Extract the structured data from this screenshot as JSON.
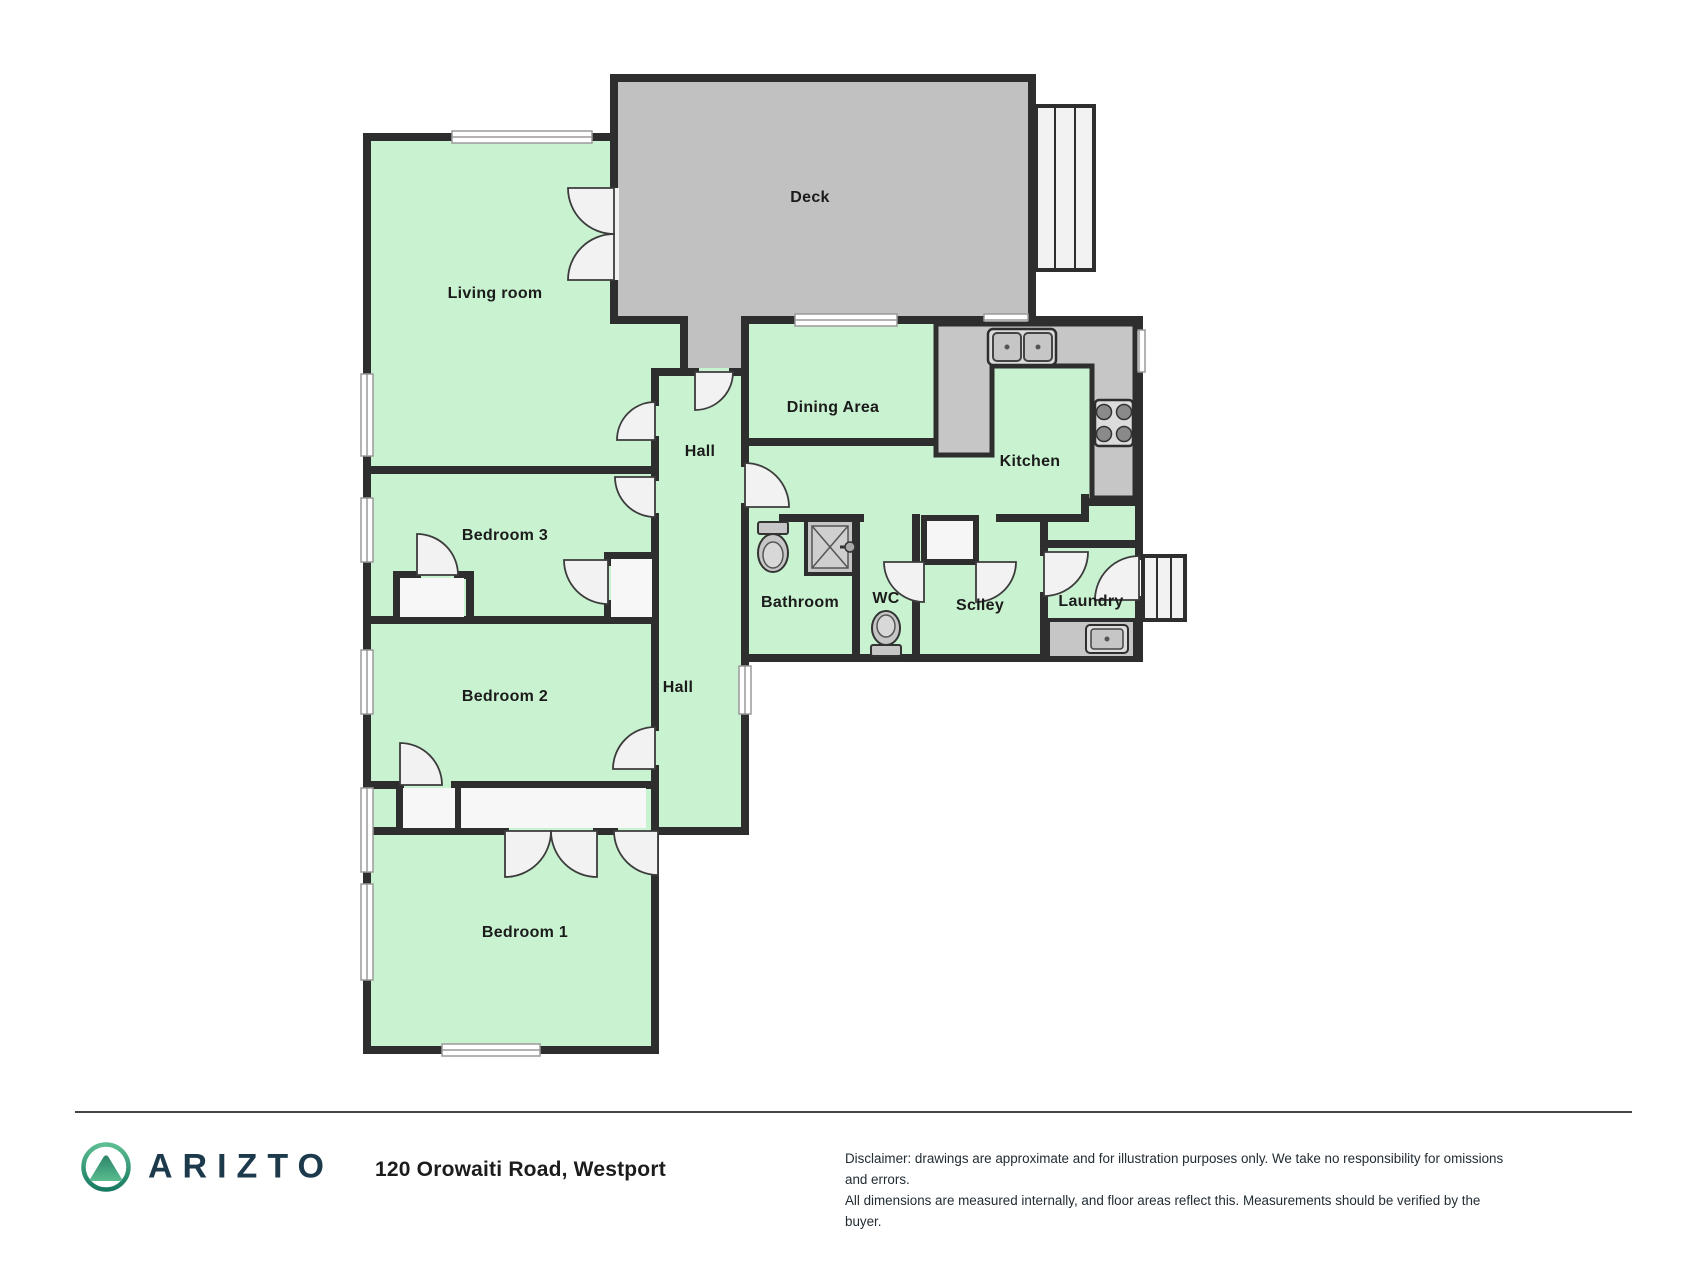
{
  "floorplan": {
    "rooms": {
      "living": "Living room",
      "deck": "Deck",
      "hall_upper": "Hall",
      "dining": "Dining Area",
      "kitchen": "Kitchen",
      "bathroom": "Bathroom",
      "wc": "WC",
      "scullery": "Sclley",
      "laundry": "Laundry",
      "hall_lower": "Hall",
      "bedroom3": "Bedroom 3",
      "bedroom2": "Bedroom 2",
      "bedroom1": "Bedroom 1"
    },
    "colors": {
      "room_fill": "#c9f3d0",
      "deck_fill": "#c1c1c1",
      "counter_fill": "#c6c6c6",
      "wall": "#2e2e2e"
    }
  },
  "footer": {
    "brand": "ARIZTO",
    "address": "120 Orowaiti Road, Westport",
    "disclaimer_line1": "Disclaimer: drawings are approximate and for illustration purposes only. We take no responsibility for omissions and errors.",
    "disclaimer_line2": "All dimensions are measured internally, and floor areas reflect this. Measurements should be verified by the buyer."
  }
}
